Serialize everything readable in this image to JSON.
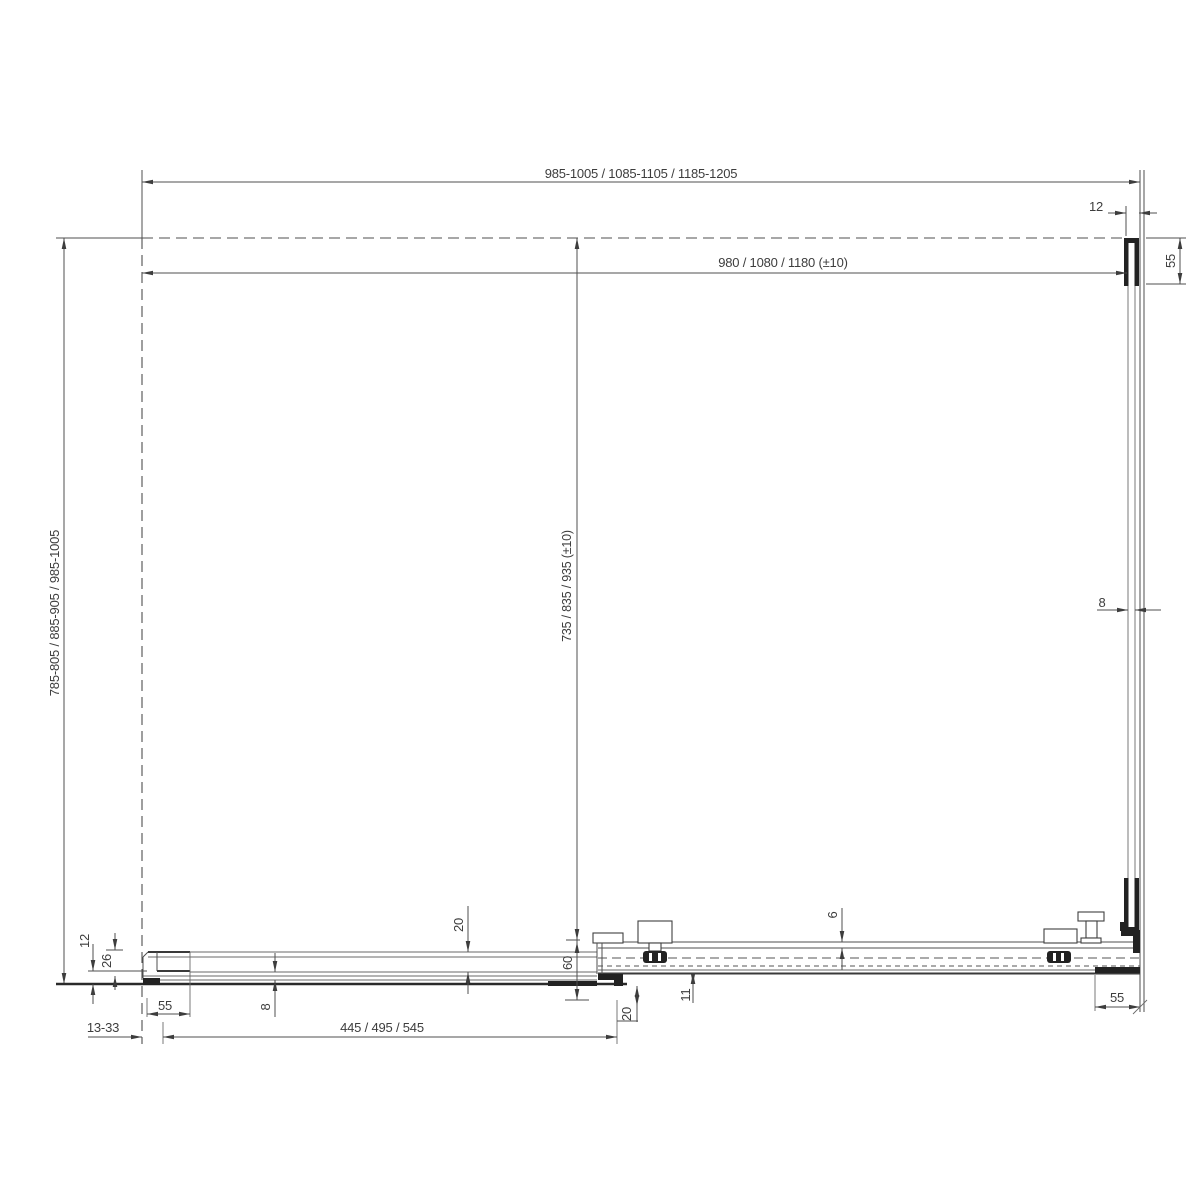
{
  "drawing": {
    "title": "Corner shower enclosure installation diagram",
    "dimensions": {
      "overall_width": "985-1005 / 1085-1105 / 1185-1205",
      "inner_width": "980 / 1080 / 1180 (±10)",
      "overall_depth": "785-805 / 885-905 / 985-1005",
      "inner_depth": "735 / 835 / 935 (±10)",
      "top_profile_gap_12": "12",
      "top_wall_profile_55": "55",
      "side_glass_thickness_8": "8",
      "left_offset_12": "12",
      "left_offset_26": "26",
      "fixed_glass_thickness_8": "8",
      "glass_inset_20": "20",
      "center_offset_60": "60",
      "wall_adjustment_range": "13-33",
      "left_wall_profile_55": "55",
      "door_glass_width": "445 / 495 / 545",
      "bracket_offset_20": "20",
      "rail_offset_11": "11",
      "rail_top_6": "6",
      "bottom_guide_55": "55"
    }
  }
}
